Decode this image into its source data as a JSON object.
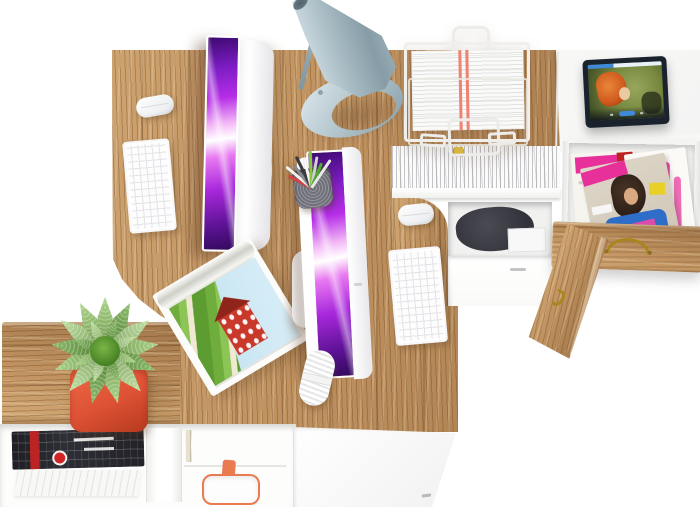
{
  "scene": {
    "description": "Top-down photo of a white and oak home office: two computer workstations on an oak corner desk system, a gray desk lamp, a wire document tray with forms, hanging files with colored tabs, an open drawer full of fashion magazines, a tablet playing an animated movie on a white side table, a succulent in a red pot on a low oak bench, and a white open shelf with magazines, books and a shopping bag.",
    "canvas_width": "700",
    "canvas_height": "507"
  },
  "colors": {
    "wood-hi": "#d4ab77",
    "wood-base": "#c09260",
    "wood-lo": "#a07548",
    "wood-line": "rgba(92,58,22,.30)",
    "lamp-hi": "#e0eaee",
    "lamp-mid": "#aec1c9",
    "lamp-lo": "#869ca6",
    "scr-deep": "#3d0a70",
    "scr-mid": "#a828dc",
    "scr-bright": "#e879f0",
    "scr-pale": "#f3b7f6",
    "pot": "#dd5134",
    "pot-dark": "#b53a1f",
    "accent-orange": "#ea7a50",
    "brass": "#a8861e",
    "mag-pink": "#e8309a",
    "mag-red": "#bc2424",
    "mag-blue": "#2e6ec8",
    "mag-yellow": "#e8d028",
    "skin": "#d9a982",
    "hair-dark": "#2e2018",
    "tab-bezel": "#1a222e",
    "tab-blue": "#3e8ad8",
    "brave-bg": "#77883f",
    "brave-hair": "#cf5a1c",
    "paper-red": "#ef8272",
    "dark-bag": "#32323a"
  },
  "objects": {
    "desk": {
      "label": "oak corner desk system"
    },
    "bench": {
      "label": "low oak bench top"
    },
    "lamp": {
      "label": "gray metal desk lamp"
    },
    "monitor_left": {
      "label": "white all-in-one computer, left workstation"
    },
    "monitor_right": {
      "label": "white all-in-one computer, right workstation"
    },
    "keyboard_left": {
      "label": "white wireless keyboard"
    },
    "keyboard_right": {
      "label": "white wireless keyboard"
    },
    "mouse_left": {
      "label": "white wireless mouse"
    },
    "mouse_right": {
      "label": "white wireless mouse"
    },
    "paper_tray": {
      "label": "white wire document tray with printed forms"
    },
    "hanging_files": {
      "label": "hanging file folders with colored index tabs"
    },
    "storage": {
      "label": "under-desk storage with dark bag"
    },
    "tablet": {
      "label": "tablet playing an animated movie"
    },
    "side_table": {
      "label": "white side table"
    },
    "drawer_mags": {
      "label": "open drawer with fashion magazines"
    },
    "drawer_front": {
      "label": "oak drawer front with brass handle"
    },
    "cabinet_door": {
      "label": "open oak cabinet door with brass handle"
    },
    "plant": {
      "label": "green succulent in a red square pot"
    },
    "house_magazine": {
      "label": "open magazine showing a red country house"
    },
    "shelf": {
      "label": "white open shelf with magazines, books and shopping bag"
    },
    "pen_cup": {
      "label": "mesh pen cup with pens and pencils"
    },
    "cable": {
      "label": "coiled white cable"
    }
  },
  "file_tabs": [
    "#e06aa8",
    "#c03838",
    "#8a46b8",
    "#b8bcc0",
    "#e8d84a",
    "#58b060",
    "#e878b0",
    "#4878c8",
    "#d04040",
    "#3898d0",
    "#e0c040"
  ],
  "pen_cup": {
    "pen_colors": [
      "#d84444",
      "#f2f2f0",
      "#8a8a92",
      "#3a3a40",
      "#f6f6f4",
      "#88c840",
      "#d0d0d4",
      "#50a830",
      "#e8e8e6"
    ]
  },
  "plant": {
    "leaf_colors": [
      "#8cc45c",
      "#61a234",
      "#a6d47e"
    ]
  },
  "book_spines": [
    "#ece5d2",
    "#f8f6ef",
    "#e0d8c2",
    "#f2eee2",
    "#e8e1cd",
    "#fbfaf5",
    "#e5ddc8",
    "#f0ebdd",
    "#e9e2cf",
    "#f6f3ea",
    "#e2dac4",
    "#f0ecdf",
    "#e7e0cc"
  ]
}
